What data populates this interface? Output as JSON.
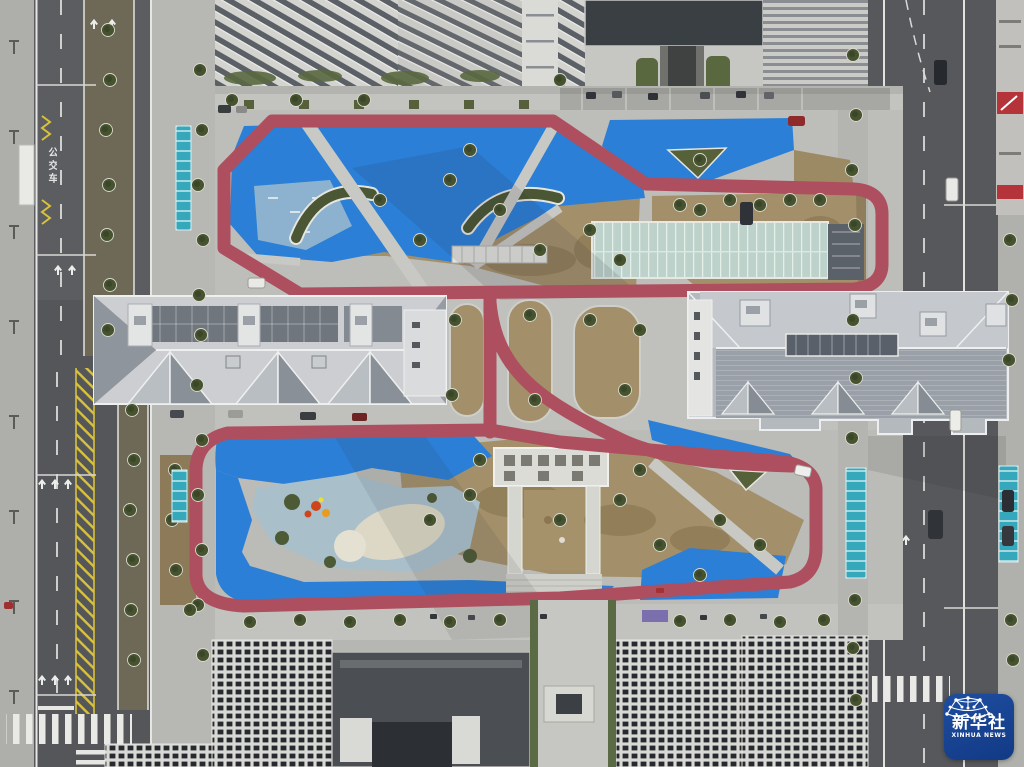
{
  "scene": {
    "setting": "Aerial drone view of a residential community fitness park: S-shaped red jogging track, bright blue playground surfaces, dormant tan lawns, two gray-roofed low buildings, a glass greenhouse, flanking city roads and high-rise apartment towers"
  },
  "watermark": {
    "name_cn": "新华社",
    "name_en": "XINHUA NEWS",
    "icon": "network-globe-icon",
    "background": "#123a85"
  },
  "road": {
    "bus_lane_text": "公交车"
  },
  "palette": {
    "track_red": "#ad4f5e",
    "playground_blue": "#2b7fd6",
    "play_inner_blue": "#a9c0cb",
    "lawn_tan": "#a3906a",
    "canopy_teal": "#35a9bb",
    "asphalt": "#55565a",
    "concrete": "#bdbdb9",
    "roof_gray": "#ccced1",
    "greenhouse_glass": "#bcd2ca",
    "median_yellow": "#d8c23c"
  }
}
